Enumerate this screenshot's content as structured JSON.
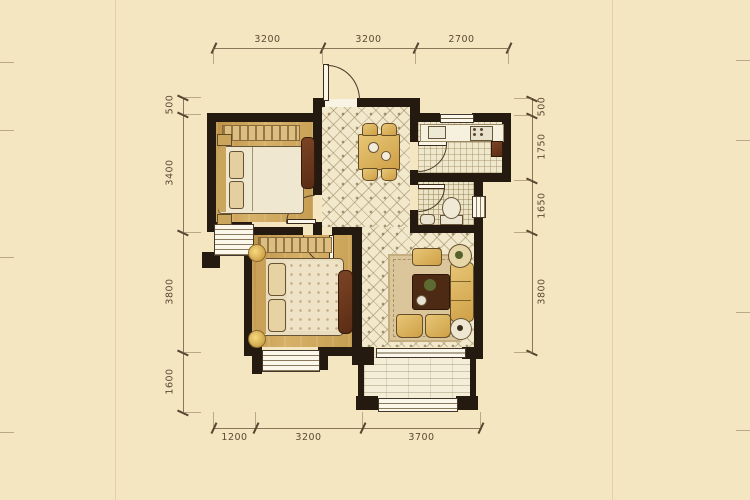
{
  "title": "two-bedroom-apartment-floor-plan",
  "dims": {
    "top": [
      "3200",
      "3200",
      "2700"
    ],
    "bottom": [
      "1200",
      "3200",
      "3700"
    ],
    "left": [
      "500",
      "3400",
      "3800",
      "1600"
    ],
    "right": [
      "500",
      "1750",
      "1650",
      "3800"
    ]
  },
  "colors": {
    "background": "#f4e6c1",
    "wall": "#241a0f",
    "bedroom_floor": "#cda45c",
    "tile_floor": "#f2e9cc",
    "furniture_gold": "#d9b15c",
    "furniture_wood": "#6e3a22",
    "dimension_text": "#5b4a33"
  }
}
